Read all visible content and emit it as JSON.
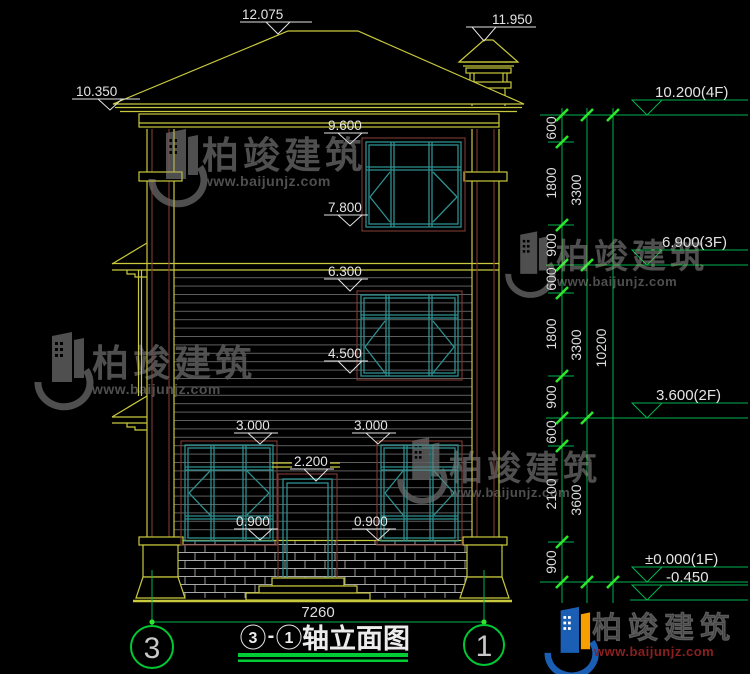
{
  "drawing": {
    "flags": {
      "ridge": "12.075",
      "chimney": "11.950",
      "eave": "10.350",
      "w3_top": "9.600",
      "w3_sill": "7.800",
      "w2_top": "6.300",
      "w2_sill": "4.500",
      "w1_top_left": "3.000",
      "w1_top_right": "3.000",
      "door_top": "2.200",
      "w1_sill_left": "0.900",
      "w1_sill_right": "0.900"
    },
    "levels": [
      "10.200(4F)",
      "6.900(3F)",
      "3.600(2F)",
      "±0.000(1F)",
      "-0.450"
    ],
    "dims": {
      "inner": [
        "600",
        "1800",
        "900",
        "600",
        "1800",
        "900",
        "600",
        "2100",
        "900"
      ],
      "middle": [
        "3300",
        "3300",
        "3600"
      ],
      "overall": "10200",
      "width": "7260"
    },
    "axes": {
      "left": "3",
      "right": "1"
    },
    "title": {
      "axis_start": "3",
      "dash": "-",
      "axis_end": "1",
      "name": "轴立面图"
    },
    "watermark": {
      "brand": "柏竣建筑",
      "url": "www.baijunjz.com"
    },
    "colors": {
      "line_yellow": "#c9c93e",
      "line_maroon": "#7d3b35",
      "window_teal": "#2f8f8f",
      "dim_green": "#00b450",
      "tick_green": "#2de62d",
      "text_white": "#e4e4e4",
      "watermark_gray": "#4f4f4f",
      "logo_blue": "#1a5fb4",
      "logo_orange": "#f59f00",
      "logo_red": "#8b1f1f",
      "background": "#000000"
    }
  }
}
